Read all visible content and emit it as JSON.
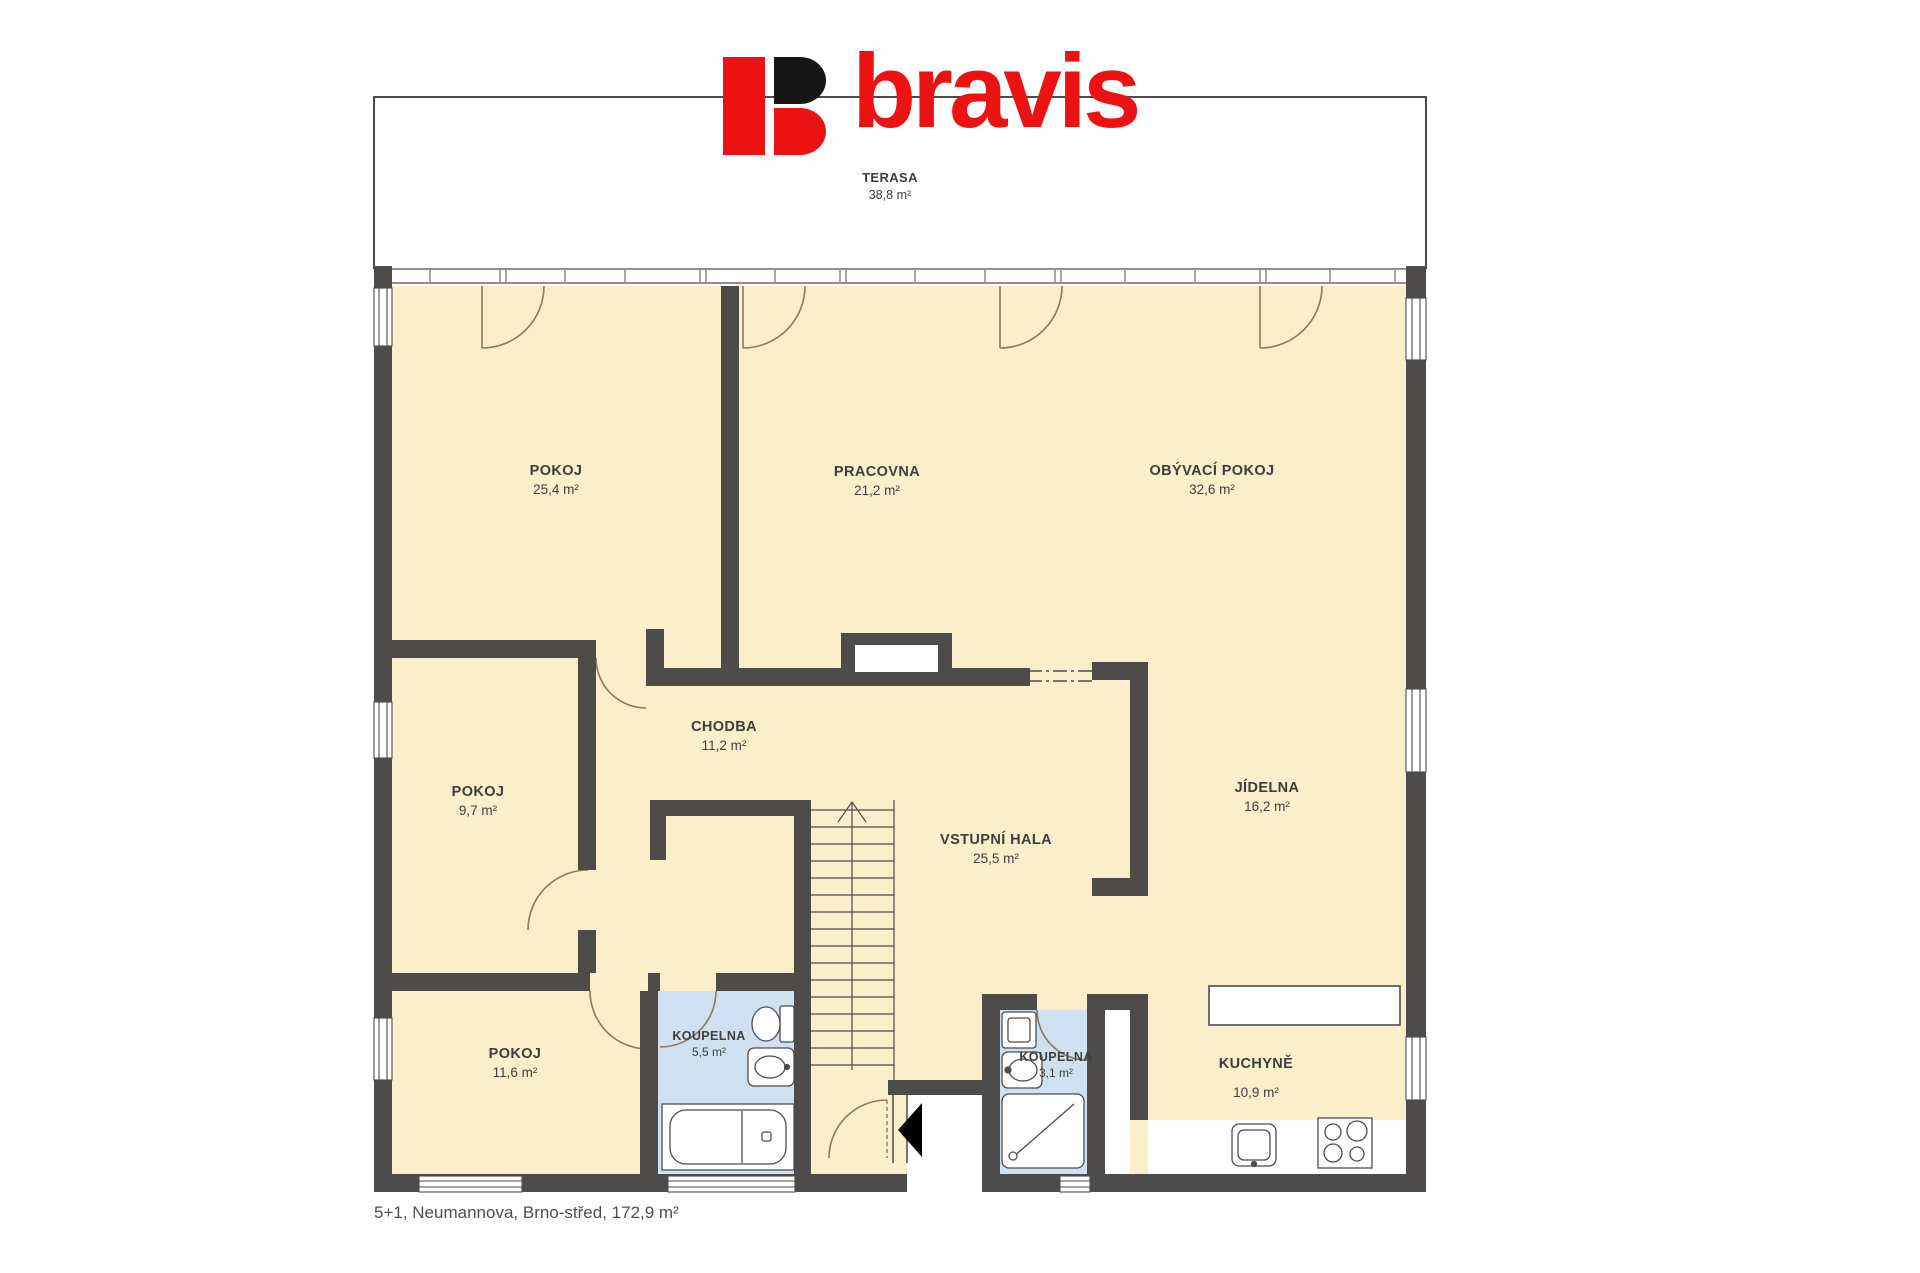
{
  "page": {
    "background": "#ffffff"
  },
  "logo": {
    "brand": "bravis",
    "red": "#ed1212",
    "black": "#161616"
  },
  "plan": {
    "wall_color": "#4d4c4b",
    "floor_color": "#faeecb",
    "bathroom_color": "#cfe1f1",
    "door_arc_color": "#8a7a5f"
  },
  "terrace": {
    "name": "TERASA",
    "area": "38,8 m²"
  },
  "rooms": [
    {
      "id": "pokoj-horni",
      "name": "POKOJ",
      "area": "25,4 m²"
    },
    {
      "id": "pracovna",
      "name": "PRACOVNA",
      "area": "21,2 m²"
    },
    {
      "id": "obyvaci-pokoj",
      "name": "OBÝVACÍ POKOJ",
      "area": "32,6 m²"
    },
    {
      "id": "chodba",
      "name": "CHODBA",
      "area": "11,2 m²"
    },
    {
      "id": "pokoj-stredni",
      "name": "POKOJ",
      "area": "9,7 m²"
    },
    {
      "id": "vstupni-hala",
      "name": "VSTUPNÍ HALA",
      "area": "25,5 m²"
    },
    {
      "id": "jidelna",
      "name": "JÍDELNA",
      "area": "16,2 m²"
    },
    {
      "id": "pokoj-dolni",
      "name": "POKOJ",
      "area": "11,6 m²"
    },
    {
      "id": "koupelna-velka",
      "name": "KOUPELNA",
      "area": "5,5 m²"
    },
    {
      "id": "koupelna-mala",
      "name": "KOUPELNA",
      "area": "3,1 m²"
    },
    {
      "id": "kuchyne",
      "name": "KUCHYNĚ",
      "area": "10,9 m²"
    }
  ],
  "footer": {
    "caption": "5+1, Neumannova, Brno-střed, 172,9 m²"
  }
}
